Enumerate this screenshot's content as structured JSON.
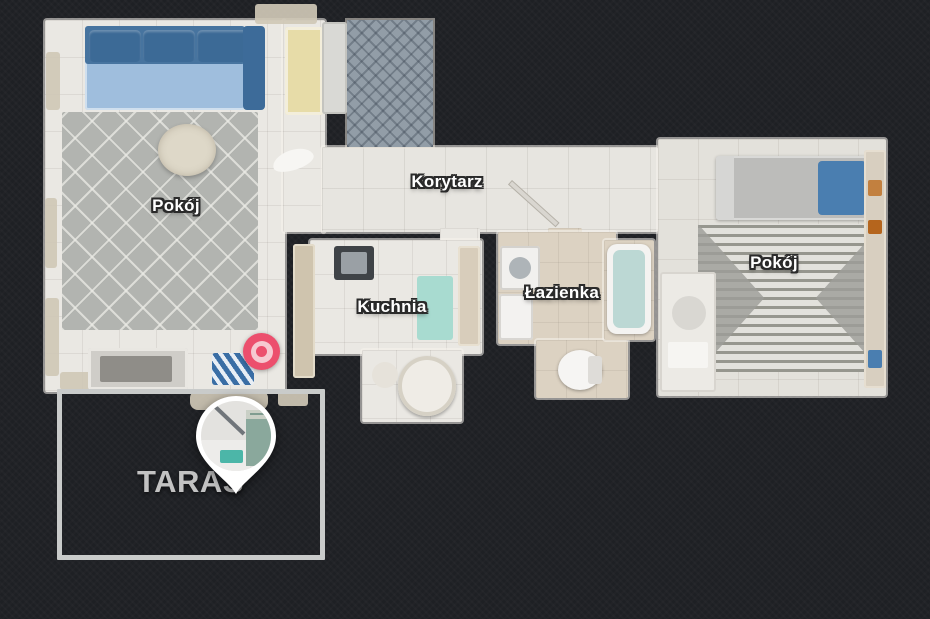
{
  "scene": {
    "kind": "apartment-floorplan-top-view",
    "background_color": "#1e2024"
  },
  "floorplan": {
    "rooms": [
      {
        "id": "pokoj-living",
        "label": "Pokój"
      },
      {
        "id": "korytarz",
        "label": "Korytarz"
      },
      {
        "id": "kuchnia",
        "label": "Kuchnia"
      },
      {
        "id": "lazienka",
        "label": "Łazienka"
      },
      {
        "id": "pokoj-bedroom",
        "label": "Pokój"
      },
      {
        "id": "taras",
        "label": "TARAS"
      }
    ],
    "markers": [
      {
        "id": "terrace-pin",
        "kind": "map-pin-with-photo",
        "fill": "#ffffff"
      },
      {
        "id": "position-bullseye",
        "kind": "bullseye",
        "outer_color": "#ec4f6d",
        "ring_color": "#f6c9d1"
      }
    ],
    "highlight": {
      "shape": "rectangle",
      "room": "TARAS",
      "stroke_color": "#c9cbca"
    }
  },
  "colors": {
    "room_label_text": "#ffffff",
    "room_label_outline": "#2a2a2a",
    "taras_label": "#c2c2c2",
    "sofa_blue": "#47749f",
    "kitchen_rug_teal": "#a8dbd0",
    "entry_tile_blue_gray": "#929da7"
  }
}
